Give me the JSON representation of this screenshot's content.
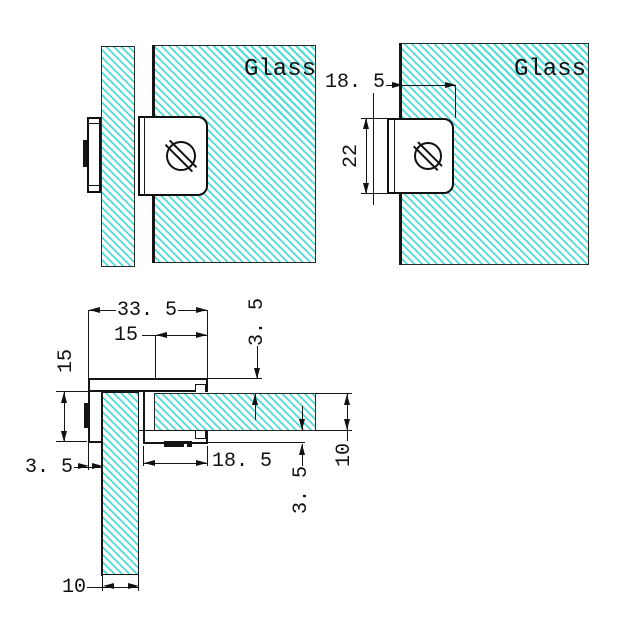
{
  "drawing": {
    "front_view": {
      "glass_label": "Glass"
    },
    "side_view": {
      "glass_label": "Glass",
      "dim_insert_width": "18. 5",
      "dim_clamp_height": "22"
    },
    "plan_view": {
      "dim_overall_width": "33. 5",
      "dim_glass_inset_top": "15",
      "dim_side_height": "15",
      "dim_wall_top": "3. 5",
      "dim_wall_left": "3. 5",
      "dim_slot_depth": "18. 5",
      "dim_wall_bottom": "3. 5",
      "dim_glass_thickness_right": "10",
      "dim_glass_thickness_bottom": "10"
    },
    "colors": {
      "hatch": "#4fdcd7",
      "line": "#111111"
    }
  }
}
